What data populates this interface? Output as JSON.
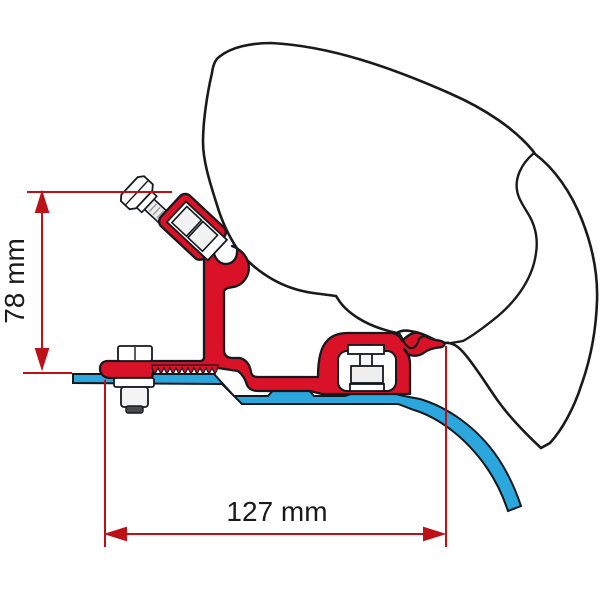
{
  "drawing": {
    "title": "awning-roof-adapter-cross-section",
    "dimensions": [
      {
        "name": "bracket-height",
        "label": "78 mm",
        "value": "78",
        "unit": "mm",
        "orientation": "vertical"
      },
      {
        "name": "bracket-width",
        "label": "127 mm",
        "value": "127",
        "unit": "mm",
        "orientation": "horizontal"
      }
    ],
    "colors": {
      "bracket_red": "#da1228",
      "roof_profile_blue": "#2ba7de",
      "dimension_red": "#bb1117",
      "outline_black": "#1a1a1a",
      "hardware_white": "#ffffff"
    },
    "parts": [
      {
        "name": "awning-case"
      },
      {
        "name": "adapter-bracket"
      },
      {
        "name": "roof-profile"
      },
      {
        "name": "clamp-bolt"
      },
      {
        "name": "rail-bolt"
      },
      {
        "name": "channel-bolt"
      }
    ]
  }
}
